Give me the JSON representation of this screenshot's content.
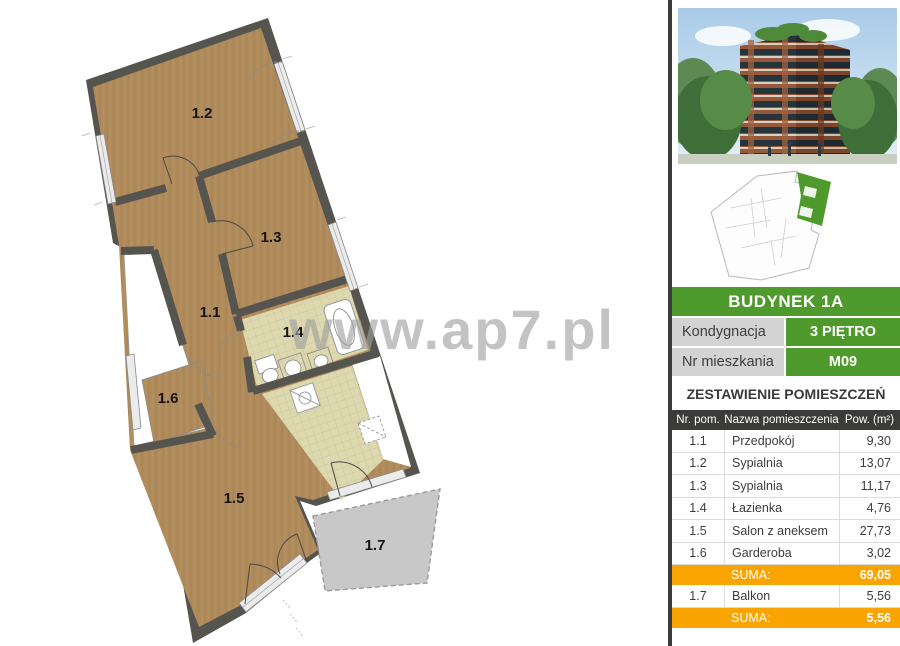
{
  "watermark": "www.ap7.pl",
  "floor_plan": {
    "labels": [
      "1.1",
      "1.2",
      "1.3",
      "1.4",
      "1.5",
      "1.6",
      "1.7"
    ],
    "colors": {
      "wall": "#56544e",
      "wood": "#b08b5c",
      "tile": "#ddd8ae",
      "balcony": "#c8c8c8"
    }
  },
  "sidebar": {
    "building_title": "BUDYNEK 1A",
    "info_rows": [
      {
        "label": "Kondygnacja",
        "value": "3 PIĘTRO"
      },
      {
        "label": "Nr mieszkania",
        "value": "M09"
      }
    ],
    "table_title": "ZESTAWIENIE POMIESZCZEŃ",
    "table": {
      "headers": [
        "Nr. pom.",
        "Nazwa pomieszczenia",
        "Pow. (m²)"
      ],
      "rows": [
        {
          "nr": "1.1",
          "name": "Przedpokój",
          "area": "9,30"
        },
        {
          "nr": "1.2",
          "name": "Sypialnia",
          "area": "13,07"
        },
        {
          "nr": "1.3",
          "name": "Sypialnia",
          "area": "11,17"
        },
        {
          "nr": "1.4",
          "name": "Łazienka",
          "area": "4,76"
        },
        {
          "nr": "1.5",
          "name": "Salon z aneksem",
          "area": "27,73"
        },
        {
          "nr": "1.6",
          "name": "Garderoba",
          "area": "3,02"
        }
      ],
      "suma1": {
        "label": "SUMA:",
        "value": "69,05"
      },
      "balcony_row": {
        "nr": "1.7",
        "name": "Balkon",
        "area": "5,56"
      },
      "suma2": {
        "label": "SUMA:",
        "value": "5,56"
      }
    },
    "colors": {
      "green": "#4e9a2c",
      "orange": "#f9a400",
      "dark": "#3b3b3a"
    }
  }
}
